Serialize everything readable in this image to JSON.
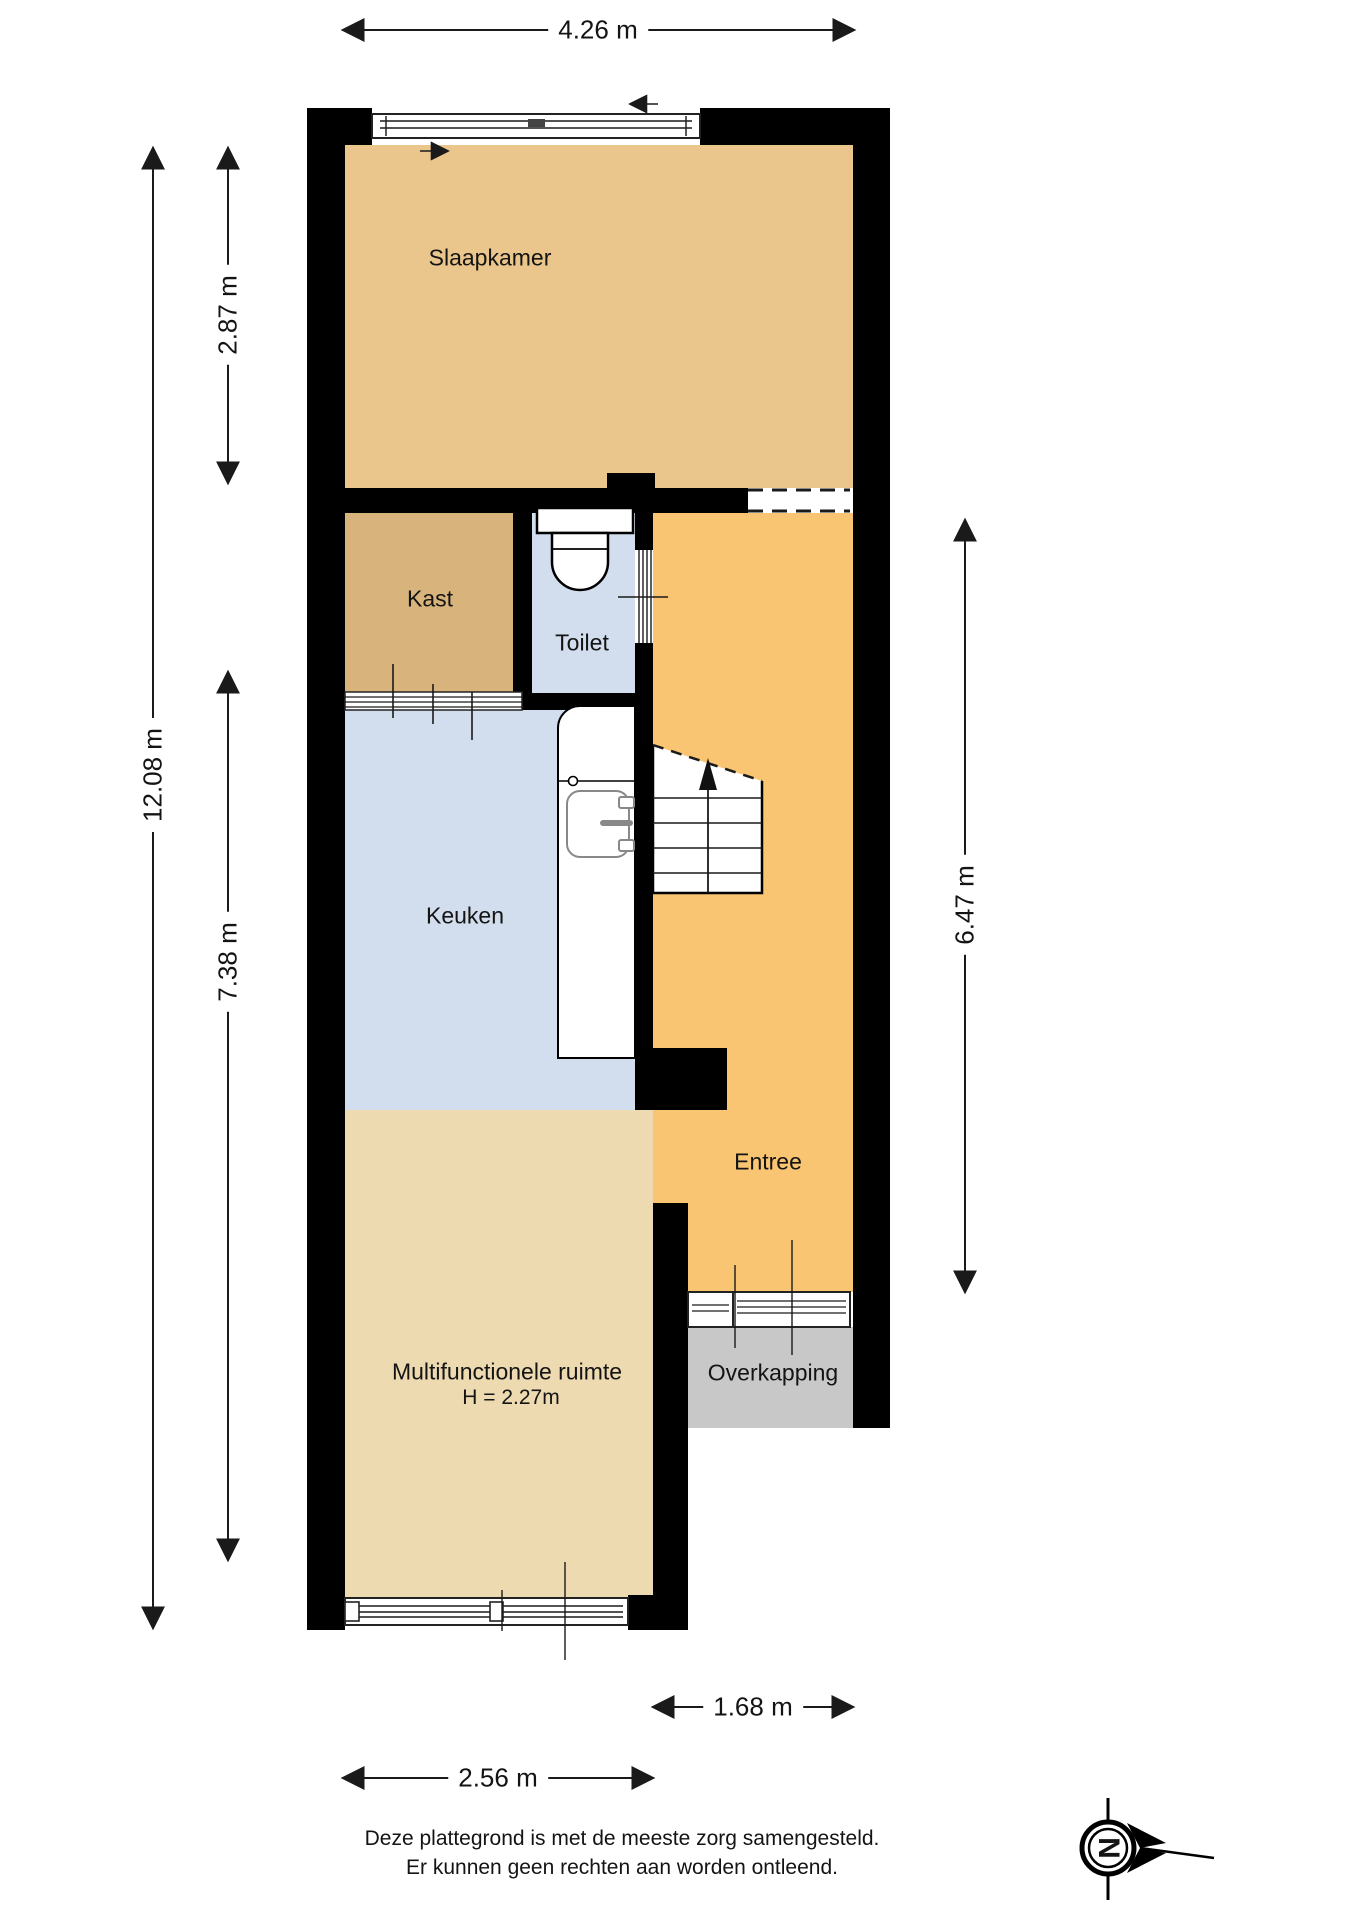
{
  "rooms": [
    {
      "id": "slaapkamer",
      "label": "Slaapkamer"
    },
    {
      "id": "kast",
      "label": "Kast"
    },
    {
      "id": "toilet",
      "label": "Toilet"
    },
    {
      "id": "keuken",
      "label": "Keuken"
    },
    {
      "id": "entree",
      "label": "Entree"
    },
    {
      "id": "multifunctionele-ruimte",
      "label": "Multifunctionele ruimte",
      "height_note": "H = 2.27m"
    },
    {
      "id": "overkapping",
      "label": "Overkapping"
    }
  ],
  "dimensions": {
    "top_width": "4.26 m",
    "left_total": "12.08 m",
    "left_upper": "2.87 m",
    "left_lower": "7.38 m",
    "right_height": "6.47 m",
    "bottom_right": "1.68 m",
    "bottom_left": "2.56 m"
  },
  "compass": {
    "north_label": "N"
  },
  "disclaimer": {
    "line1": "Deze plattegrond is met de meeste zorg samengesteld.",
    "line2": "Er kunnen geen rechten aan worden ontleend."
  },
  "colors": {
    "wall": "#000000",
    "slaapkamer": "#ebc68c",
    "kast": "#d8b47c",
    "wet": "#d2deed",
    "entree": "#fac572",
    "multi": "#eedab0",
    "overkapping": "#c8c8c8",
    "line": "#1a1a1a",
    "text": "#141414"
  }
}
